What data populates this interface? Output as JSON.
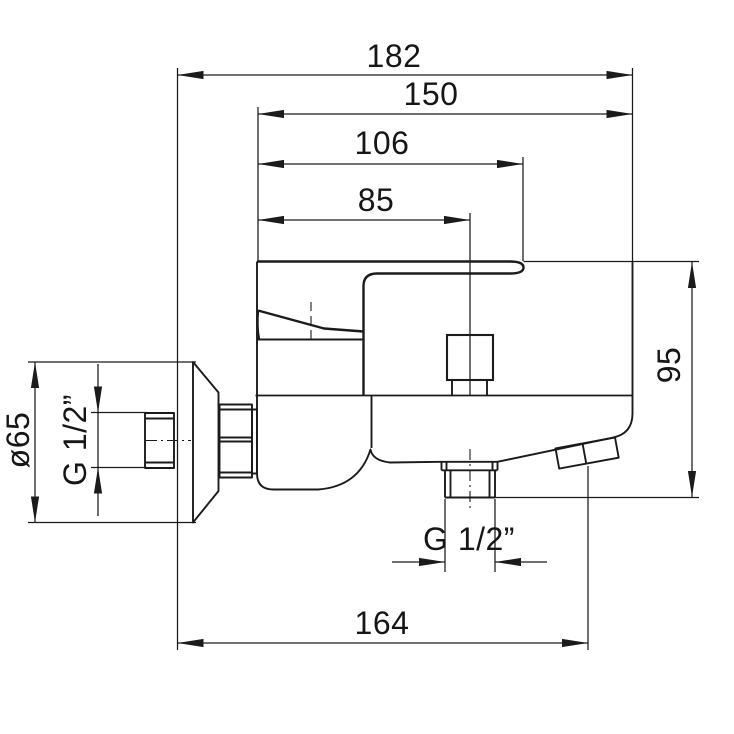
{
  "drawing": {
    "kind": "technical dimension drawing",
    "subject": "wall-mounted single-lever bath mixer tap, side view"
  },
  "labels": {
    "total_projection": "182",
    "body_projection": "150",
    "lever_reach": "106",
    "shower_outlet_offset": "85",
    "body_height": "95",
    "spout_reach": "164",
    "escutcheon_diameter": "ø65",
    "wall_thread": "G 1/2”",
    "shower_outlet_thread": "G 1/2”"
  },
  "colors": {
    "background": "#ffffff",
    "line": "#1b1b1b"
  }
}
